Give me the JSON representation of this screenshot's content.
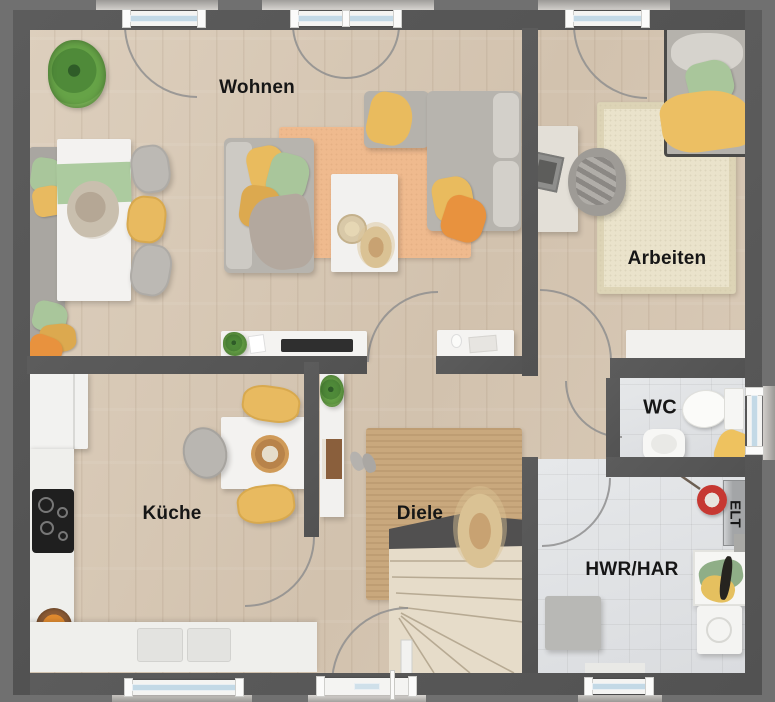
{
  "rooms": {
    "living": {
      "label": "Wohnen"
    },
    "office": {
      "label": "Arbeiten"
    },
    "kitchen": {
      "label": "Küche"
    },
    "hall": {
      "label": "Diele"
    },
    "wc": {
      "label": "WC"
    },
    "utility": {
      "label": "HWR/HAR"
    },
    "electrical": {
      "label": "ELT"
    }
  },
  "colors": {
    "bg": "#707070",
    "wall": "#565656",
    "wood": "#d7c9b6",
    "tile": "#e2e4e6",
    "yellow": "#e8ba60",
    "green": "#a9c69b",
    "orange": "#e8923e",
    "rug_peach": "#efba8e",
    "rug_jute": "#c9a87d",
    "rug_cream": "#eae3cb",
    "white_f": "#f3f2f0",
    "gray_sofa": "#b7b4ae",
    "red": "#c63832",
    "ink": "#161616"
  }
}
